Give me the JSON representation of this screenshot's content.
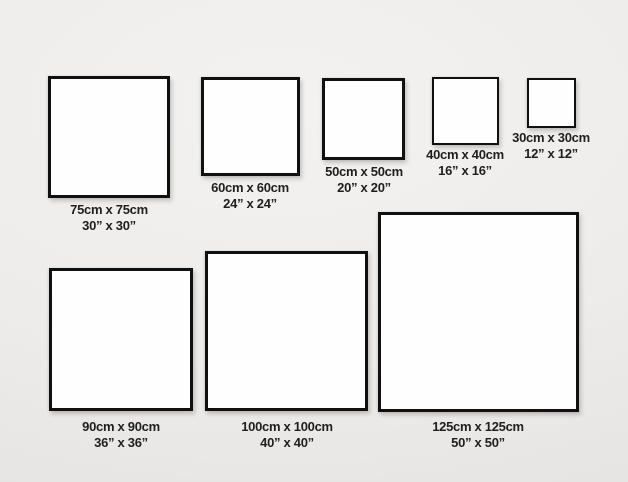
{
  "chart_type": "size-comparison-diagram",
  "items": [
    {
      "id": "75cm",
      "cm_label": "75cm x 75cm",
      "inch_label": "30” x 30”"
    },
    {
      "id": "60cm",
      "cm_label": "60cm x 60cm",
      "inch_label": "24” x 24”"
    },
    {
      "id": "50cm",
      "cm_label": "50cm x 50cm",
      "inch_label": "20” x 20”"
    },
    {
      "id": "40cm",
      "cm_label": "40cm x 40cm",
      "inch_label": "16” x 16”"
    },
    {
      "id": "30cm",
      "cm_label": "30cm x 30cm",
      "inch_label": "12” x 12”"
    },
    {
      "id": "90cm",
      "cm_label": "90cm x 90cm",
      "inch_label": "36” x 36”"
    },
    {
      "id": "100cm",
      "cm_label": "100cm x 100cm",
      "inch_label": "40” x 40”"
    },
    {
      "id": "125cm",
      "cm_label": "125cm x 125cm",
      "inch_label": "50” x 50”"
    }
  ],
  "colors": {
    "bg_light": "#f4f2f0",
    "bg_mid": "#eeecea",
    "bg_dark": "#e5e3e1",
    "frame_fill": "#fefefe",
    "frame_border": "#101010",
    "label_text": "#1f1f1f"
  }
}
